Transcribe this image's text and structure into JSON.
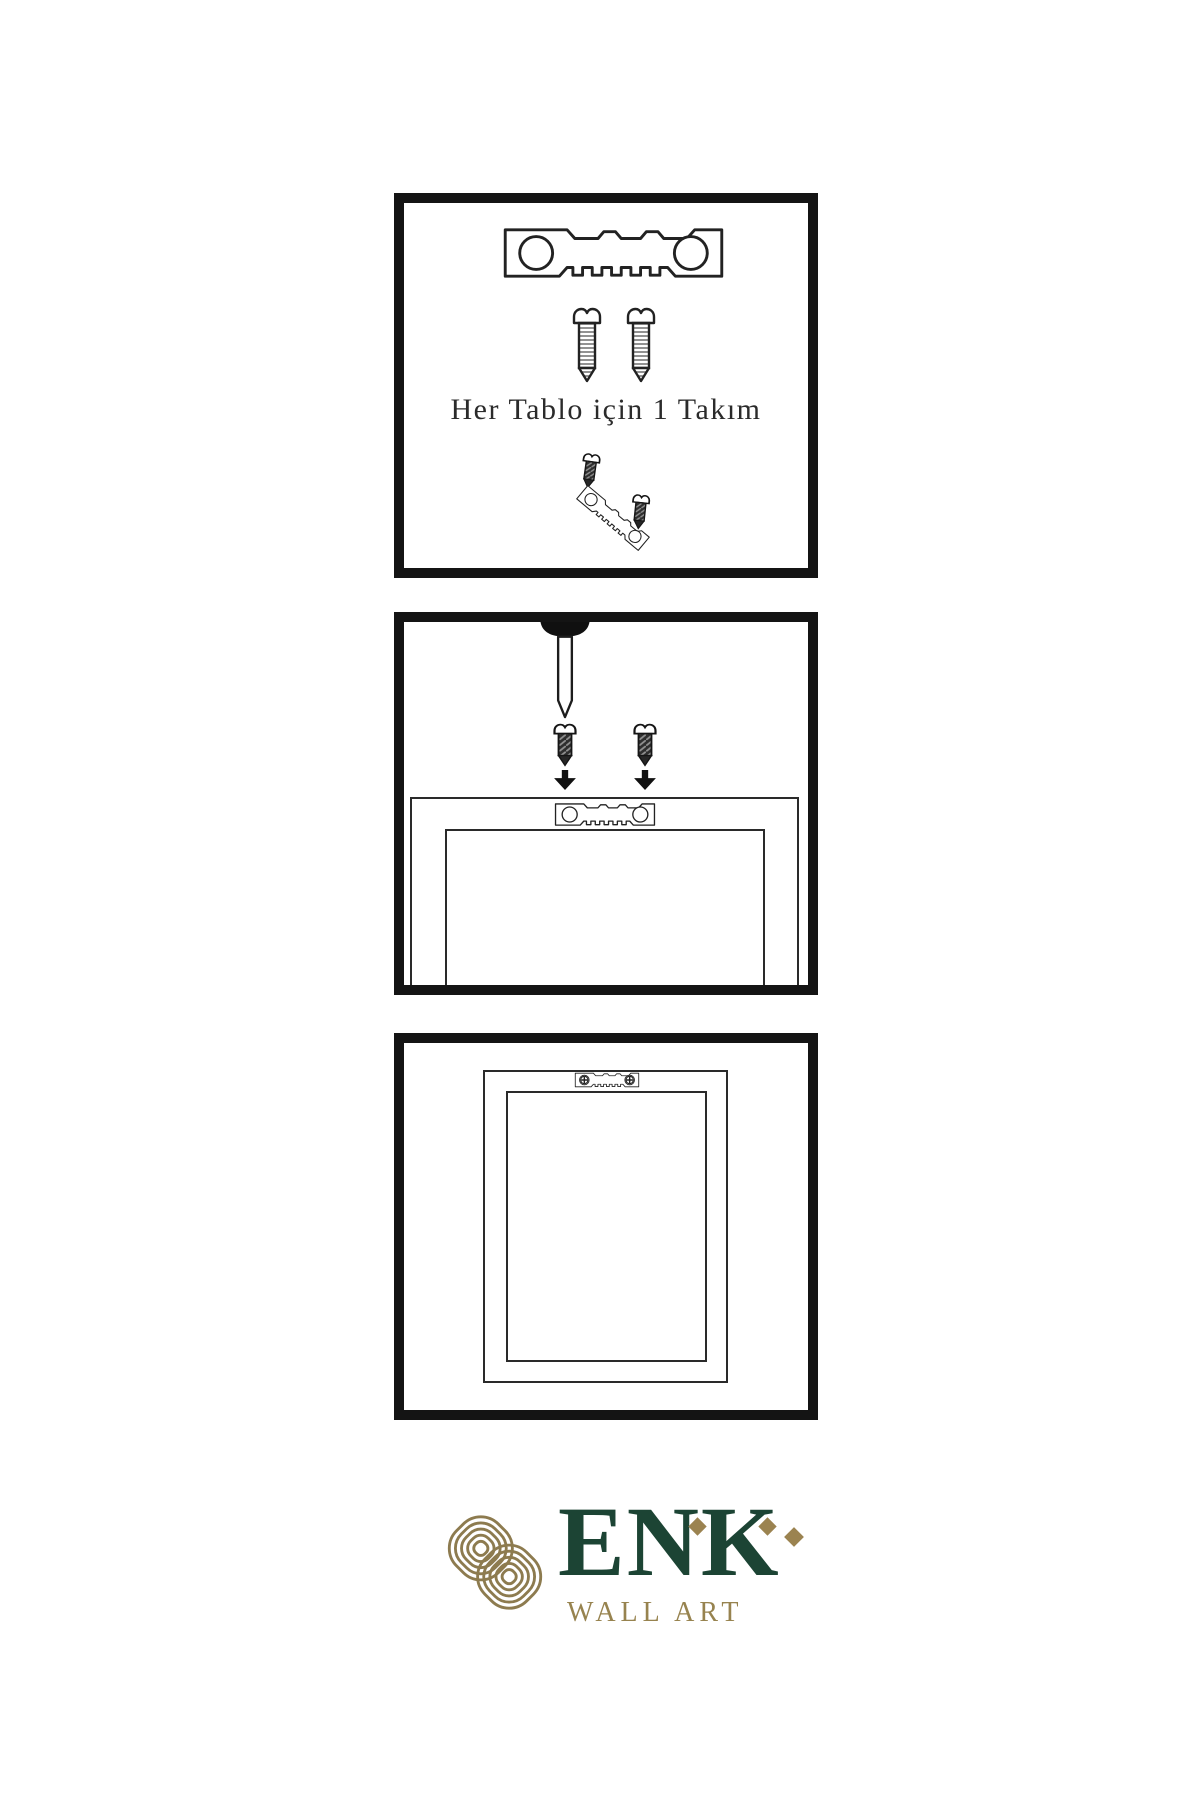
{
  "document": {
    "background": "#ffffff",
    "ink_color": "#222222",
    "panel_border_color": "#141414"
  },
  "panels": {
    "hardware_kit": {
      "caption": "Her Tablo için 1 Takım",
      "items": [
        "sawtooth-hanger",
        "screw",
        "screw",
        "screw",
        "tilted-sawtooth-hanger",
        "screw"
      ]
    },
    "install_step": {
      "items": [
        "wall-nail",
        "screw",
        "screw",
        "down-arrow",
        "down-arrow",
        "frame-back",
        "sawtooth-hanger"
      ]
    },
    "mounted_frame": {
      "items": [
        "frame-back",
        "sawtooth-hanger-with-screws"
      ]
    }
  },
  "brand": {
    "name": "ENK",
    "subtitle": "WALL ART",
    "colors": {
      "green": "#1c4434",
      "knot_gold": "#8d7b4f",
      "text_gold": "#97834f",
      "diamond_gold": "#9b8350"
    }
  }
}
